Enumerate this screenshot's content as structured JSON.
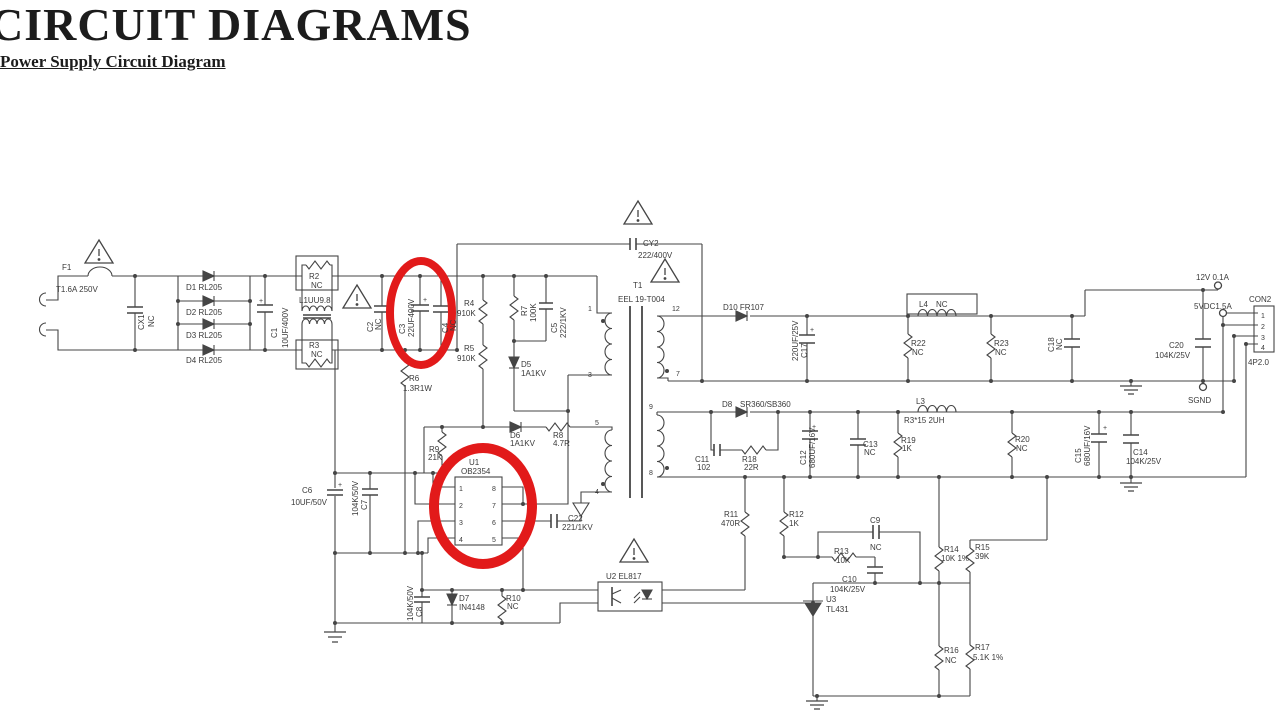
{
  "page": {
    "title": "CIRCUIT DIAGRAMS",
    "subtitle": "Power Supply Circuit Diagram"
  },
  "schematic": {
    "line_color": "#454545",
    "text_color": "#3a3a3a",
    "highlight_color": "#e21a1a",
    "labels": [
      {
        "t": "F1",
        "x": 62,
        "y": 270
      },
      {
        "t": "T1.6A 250V",
        "x": 56,
        "y": 292
      },
      {
        "t": "CX1",
        "x": 144,
        "y": 330,
        "r": -90
      },
      {
        "t": "NC",
        "x": 154,
        "y": 327,
        "r": -90
      },
      {
        "t": "D1 RL205",
        "x": 186,
        "y": 290
      },
      {
        "t": "D2 RL205",
        "x": 186,
        "y": 315
      },
      {
        "t": "D3 RL205",
        "x": 186,
        "y": 338
      },
      {
        "t": "D4 RL205",
        "x": 186,
        "y": 363
      },
      {
        "t": "+",
        "x": 259,
        "y": 303,
        "fs": 7
      },
      {
        "t": "C1",
        "x": 277,
        "y": 338,
        "r": -90
      },
      {
        "t": "10UF/400V",
        "x": 288,
        "y": 348,
        "r": -90
      },
      {
        "t": "R2",
        "x": 309,
        "y": 279
      },
      {
        "t": "NC",
        "x": 311,
        "y": 288
      },
      {
        "t": "L1UU9.8",
        "x": 299,
        "y": 303
      },
      {
        "t": "R3",
        "x": 309,
        "y": 348
      },
      {
        "t": "NC",
        "x": 311,
        "y": 357
      },
      {
        "t": "C2",
        "x": 373,
        "y": 332,
        "r": -90
      },
      {
        "t": "NC",
        "x": 381,
        "y": 330,
        "r": -90
      },
      {
        "t": "C3",
        "x": 405,
        "y": 334,
        "r": -90
      },
      {
        "t": "22UF400V",
        "x": 414,
        "y": 337,
        "r": -90
      },
      {
        "t": "+",
        "x": 423,
        "y": 302,
        "fs": 7
      },
      {
        "t": "C4",
        "x": 448,
        "y": 333,
        "r": -90
      },
      {
        "t": "NC",
        "x": 456,
        "y": 331,
        "r": -90
      },
      {
        "t": "R4",
        "x": 464,
        "y": 306
      },
      {
        "t": "910K",
        "x": 457,
        "y": 316
      },
      {
        "t": "R5",
        "x": 464,
        "y": 351
      },
      {
        "t": "910K",
        "x": 457,
        "y": 361
      },
      {
        "t": "R6",
        "x": 409,
        "y": 381
      },
      {
        "t": "1.3R1W",
        "x": 403,
        "y": 391
      },
      {
        "t": "R7",
        "x": 527,
        "y": 316,
        "r": -90
      },
      {
        "t": "100K",
        "x": 536,
        "y": 322,
        "r": -90
      },
      {
        "t": "C5",
        "x": 557,
        "y": 333,
        "r": -90
      },
      {
        "t": "222/1KV",
        "x": 566,
        "y": 338,
        "r": -90
      },
      {
        "t": "D5",
        "x": 521,
        "y": 367
      },
      {
        "t": "1A1KV",
        "x": 521,
        "y": 376
      },
      {
        "t": "CY2",
        "x": 643,
        "y": 246
      },
      {
        "t": "222/400V",
        "x": 638,
        "y": 258
      },
      {
        "t": "T1",
        "x": 633,
        "y": 288
      },
      {
        "t": "EEL 19-T004",
        "x": 618,
        "y": 302
      },
      {
        "t": "D10 FR107",
        "x": 723,
        "y": 310
      },
      {
        "t": "1",
        "x": 588,
        "y": 311,
        "fs": 7
      },
      {
        "t": "3",
        "x": 588,
        "y": 377,
        "fs": 7
      },
      {
        "t": "12",
        "x": 672,
        "y": 311,
        "fs": 7
      },
      {
        "t": "7",
        "x": 676,
        "y": 376,
        "fs": 7
      },
      {
        "t": "5",
        "x": 595,
        "y": 425,
        "fs": 7
      },
      {
        "t": "4",
        "x": 595,
        "y": 494,
        "fs": 7
      },
      {
        "t": "9",
        "x": 649,
        "y": 409,
        "fs": 7
      },
      {
        "t": "8",
        "x": 649,
        "y": 475,
        "fs": 7
      },
      {
        "t": "U1",
        "x": 469,
        "y": 465
      },
      {
        "t": "OB2354",
        "x": 461,
        "y": 474
      },
      {
        "t": "1",
        "x": 459,
        "y": 491,
        "fs": 7
      },
      {
        "t": "2",
        "x": 459,
        "y": 508,
        "fs": 7
      },
      {
        "t": "3",
        "x": 459,
        "y": 525,
        "fs": 7
      },
      {
        "t": "4",
        "x": 459,
        "y": 542,
        "fs": 7
      },
      {
        "t": "8",
        "x": 492,
        "y": 491,
        "fs": 7
      },
      {
        "t": "7",
        "x": 492,
        "y": 508,
        "fs": 7
      },
      {
        "t": "6",
        "x": 492,
        "y": 525,
        "fs": 7
      },
      {
        "t": "5",
        "x": 492,
        "y": 542,
        "fs": 7
      },
      {
        "t": "R9",
        "x": 429,
        "y": 452
      },
      {
        "t": "21K",
        "x": 428,
        "y": 460
      },
      {
        "t": "D6",
        "x": 510,
        "y": 438
      },
      {
        "t": "1A1KV",
        "x": 510,
        "y": 446
      },
      {
        "t": "R8",
        "x": 553,
        "y": 438
      },
      {
        "t": "4.7R",
        "x": 553,
        "y": 446
      },
      {
        "t": "C22",
        "x": 568,
        "y": 521
      },
      {
        "t": "221/1KV",
        "x": 562,
        "y": 530
      },
      {
        "t": "C6",
        "x": 302,
        "y": 493
      },
      {
        "t": "10UF/50V",
        "x": 291,
        "y": 505
      },
      {
        "t": "+",
        "x": 338,
        "y": 487,
        "fs": 7
      },
      {
        "t": "104K/50V",
        "x": 358,
        "y": 516,
        "r": -90
      },
      {
        "t": "C7",
        "x": 367,
        "y": 510,
        "r": -90
      },
      {
        "t": "104K/50V",
        "x": 413,
        "y": 621,
        "r": -90
      },
      {
        "t": "C8",
        "x": 422,
        "y": 617,
        "r": -90
      },
      {
        "t": "D7",
        "x": 459,
        "y": 601
      },
      {
        "t": "IN4148",
        "x": 459,
        "y": 610
      },
      {
        "t": "R10",
        "x": 506,
        "y": 601
      },
      {
        "t": "NC",
        "x": 507,
        "y": 609
      },
      {
        "t": "U2 EL817",
        "x": 606,
        "y": 579
      },
      {
        "t": "R11",
        "x": 724,
        "y": 517
      },
      {
        "t": "470R",
        "x": 721,
        "y": 526
      },
      {
        "t": "R12",
        "x": 789,
        "y": 517
      },
      {
        "t": "1K",
        "x": 789,
        "y": 526
      },
      {
        "t": "C9",
        "x": 870,
        "y": 523
      },
      {
        "t": "NC",
        "x": 870,
        "y": 550
      },
      {
        "t": "R13",
        "x": 834,
        "y": 554
      },
      {
        "t": "10K",
        "x": 836,
        "y": 563
      },
      {
        "t": "C10",
        "x": 842,
        "y": 582
      },
      {
        "t": "104K/25V",
        "x": 830,
        "y": 592
      },
      {
        "t": "U3",
        "x": 826,
        "y": 602
      },
      {
        "t": "TL431",
        "x": 826,
        "y": 612
      },
      {
        "t": "R14",
        "x": 944,
        "y": 552
      },
      {
        "t": "10K 1%",
        "x": 941,
        "y": 561
      },
      {
        "t": "R15",
        "x": 975,
        "y": 550
      },
      {
        "t": "39K",
        "x": 975,
        "y": 559
      },
      {
        "t": "R16",
        "x": 944,
        "y": 653
      },
      {
        "t": "NC",
        "x": 945,
        "y": 663
      },
      {
        "t": "R17",
        "x": 975,
        "y": 650
      },
      {
        "t": "5.1K 1%",
        "x": 973,
        "y": 660
      },
      {
        "t": "D8",
        "x": 722,
        "y": 407
      },
      {
        "t": "SR360/SB360",
        "x": 740,
        "y": 407
      },
      {
        "t": "C11",
        "x": 695,
        "y": 462
      },
      {
        "t": "102",
        "x": 697,
        "y": 470
      },
      {
        "t": "R18",
        "x": 742,
        "y": 462
      },
      {
        "t": "22R",
        "x": 744,
        "y": 470
      },
      {
        "t": "+",
        "x": 812,
        "y": 429,
        "fs": 7
      },
      {
        "t": "C12",
        "x": 806,
        "y": 465,
        "r": -90
      },
      {
        "t": "680UF/16V",
        "x": 815,
        "y": 468,
        "r": -90
      },
      {
        "t": "C13",
        "x": 863,
        "y": 447
      },
      {
        "t": "NC",
        "x": 864,
        "y": 455
      },
      {
        "t": "R19",
        "x": 901,
        "y": 443
      },
      {
        "t": "1K",
        "x": 902,
        "y": 451
      },
      {
        "t": "L3",
        "x": 916,
        "y": 404
      },
      {
        "t": "R3*15 2UH",
        "x": 904,
        "y": 423
      },
      {
        "t": "+",
        "x": 810,
        "y": 332,
        "fs": 7
      },
      {
        "t": "220UF/25V",
        "x": 798,
        "y": 361,
        "r": -90
      },
      {
        "t": "C17",
        "x": 807,
        "y": 358,
        "r": -90
      },
      {
        "t": "L4",
        "x": 919,
        "y": 307
      },
      {
        "t": "NC",
        "x": 936,
        "y": 307
      },
      {
        "t": "R22",
        "x": 911,
        "y": 346
      },
      {
        "t": "NC",
        "x": 912,
        "y": 355
      },
      {
        "t": "R23",
        "x": 994,
        "y": 346
      },
      {
        "t": "NC",
        "x": 995,
        "y": 355
      },
      {
        "t": "R20",
        "x": 1015,
        "y": 442
      },
      {
        "t": "NC",
        "x": 1016,
        "y": 451
      },
      {
        "t": "C18",
        "x": 1054,
        "y": 352,
        "r": -90
      },
      {
        "t": "NC",
        "x": 1062,
        "y": 350,
        "r": -90
      },
      {
        "t": "+",
        "x": 1103,
        "y": 430,
        "fs": 7
      },
      {
        "t": "C15",
        "x": 1081,
        "y": 463,
        "r": -90
      },
      {
        "t": "680UF/16V",
        "x": 1090,
        "y": 466,
        "r": -90
      },
      {
        "t": "C14",
        "x": 1133,
        "y": 455
      },
      {
        "t": "104K/25V",
        "x": 1126,
        "y": 464
      },
      {
        "t": "C20",
        "x": 1169,
        "y": 348
      },
      {
        "t": "104K/25V",
        "x": 1155,
        "y": 358
      },
      {
        "t": "12V 0.1A",
        "x": 1196,
        "y": 280
      },
      {
        "t": "5VDC1.5A",
        "x": 1194,
        "y": 309
      },
      {
        "t": "CON2",
        "x": 1249,
        "y": 302
      },
      {
        "t": "4P2.0",
        "x": 1248,
        "y": 365
      },
      {
        "t": "1",
        "x": 1261,
        "y": 318,
        "fs": 7
      },
      {
        "t": "2",
        "x": 1261,
        "y": 329,
        "fs": 7
      },
      {
        "t": "3",
        "x": 1261,
        "y": 340,
        "fs": 7
      },
      {
        "t": "4",
        "x": 1261,
        "y": 350,
        "fs": 7
      },
      {
        "t": "SGND",
        "x": 1188,
        "y": 403
      }
    ]
  }
}
